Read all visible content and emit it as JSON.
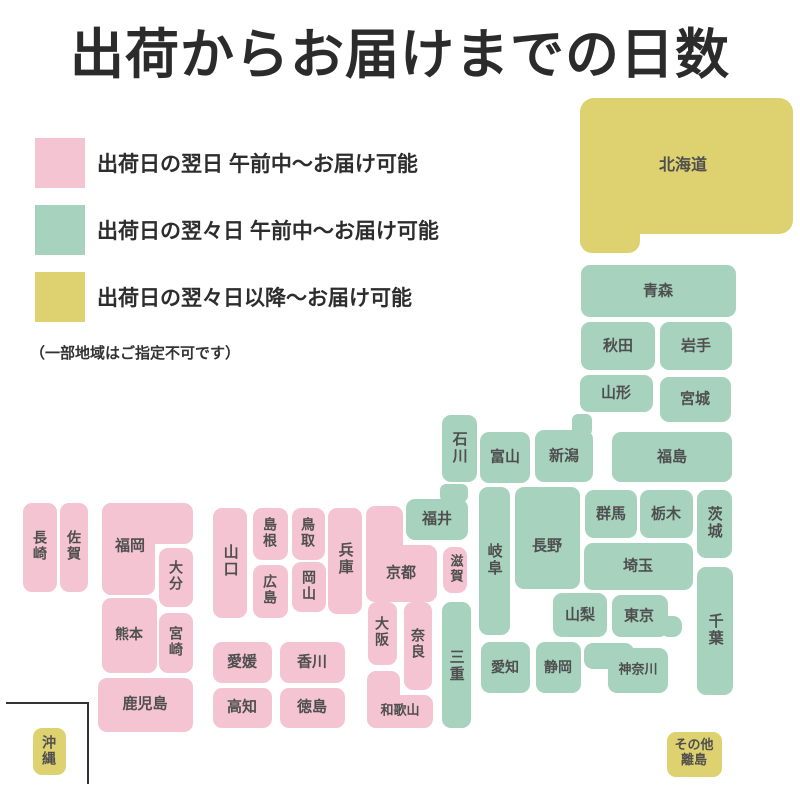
{
  "title": "出荷からお届けまでの日数",
  "legend": {
    "items": [
      {
        "key": "pink",
        "label": "出荷日の翌日 午前中〜お届け可能"
      },
      {
        "key": "green",
        "label": "出荷日の翌々日 午前中〜お届け可能"
      },
      {
        "key": "yellow",
        "label": "出荷日の翌々日以降〜お届け可能"
      }
    ],
    "note": "（一部地域はご指定不可です）"
  },
  "colors": {
    "pink": "#F4C4D3",
    "green": "#A7D3BE",
    "yellow": "#DED16F",
    "label_text": "#4F4F4F",
    "title_text": "#2B2B2B",
    "inset_frame": "#333333"
  },
  "map": {
    "regions": [
      {
        "id": "hokkaido",
        "label": "北海道",
        "color": "yellow",
        "rects": [
          [
            580,
            98,
            213,
            136,
            14
          ],
          [
            580,
            200,
            60,
            53,
            12
          ]
        ],
        "lc": [
          683,
          166
        ],
        "fs": 16
      },
      {
        "id": "aomori",
        "label": "青森",
        "color": "green",
        "rects": [
          [
            581,
            265,
            155,
            52
          ]
        ],
        "lc": [
          658,
          291
        ]
      },
      {
        "id": "akita",
        "label": "秋田",
        "color": "green",
        "rects": [
          [
            581,
            322,
            74,
            48
          ]
        ],
        "lc": [
          618,
          346
        ]
      },
      {
        "id": "iwate",
        "label": "岩手",
        "color": "green",
        "rects": [
          [
            660,
            322,
            72,
            48
          ]
        ],
        "lc": [
          696,
          346
        ]
      },
      {
        "id": "yamagata",
        "label": "山形",
        "color": "green",
        "rects": [
          [
            580,
            375,
            73,
            37
          ]
        ],
        "lc": [
          616,
          393
        ]
      },
      {
        "id": "miyagi",
        "label": "宮城",
        "color": "green",
        "rects": [
          [
            660,
            377,
            71,
            45
          ]
        ],
        "lc": [
          695,
          399
        ]
      },
      {
        "id": "niigata",
        "label": "新潟",
        "color": "green",
        "rects": [
          [
            535,
            430,
            58,
            52
          ],
          [
            572,
            414,
            20,
            22,
            6
          ]
        ],
        "lc": [
          564,
          456
        ]
      },
      {
        "id": "fukushima",
        "label": "福島",
        "color": "green",
        "rects": [
          [
            612,
            432,
            120,
            50
          ]
        ],
        "lc": [
          672,
          457
        ]
      },
      {
        "id": "ishikawa",
        "label": "石川",
        "color": "green",
        "v": true,
        "rects": [
          [
            442,
            415,
            35,
            67
          ]
        ],
        "lc": [
          459,
          448
        ]
      },
      {
        "id": "toyama",
        "label": "富山",
        "color": "green",
        "rects": [
          [
            480,
            432,
            50,
            51
          ]
        ],
        "lc": [
          505,
          457
        ]
      },
      {
        "id": "gunma",
        "label": "群馬",
        "color": "green",
        "rects": [
          [
            585,
            490,
            52,
            48
          ]
        ],
        "lc": [
          611,
          514
        ]
      },
      {
        "id": "tochigi",
        "label": "栃木",
        "color": "green",
        "rects": [
          [
            640,
            490,
            53,
            48
          ]
        ],
        "lc": [
          666,
          514
        ]
      },
      {
        "id": "ibaraki",
        "label": "茨城",
        "color": "green",
        "v": true,
        "rects": [
          [
            697,
            490,
            35,
            68
          ]
        ],
        "lc": [
          714,
          523
        ]
      },
      {
        "id": "fukui",
        "label": "福井",
        "color": "green",
        "rects": [
          [
            406,
            499,
            62,
            41
          ],
          [
            440,
            484,
            28,
            18,
            6
          ]
        ],
        "lc": [
          437,
          519
        ]
      },
      {
        "id": "gifu",
        "label": "岐阜",
        "color": "green",
        "v": true,
        "rects": [
          [
            479,
            487,
            31,
            148
          ]
        ],
        "lc": [
          494,
          560
        ]
      },
      {
        "id": "nagano",
        "label": "長野",
        "color": "green",
        "rects": [
          [
            515,
            487,
            65,
            102
          ]
        ],
        "lc": [
          547,
          546
        ]
      },
      {
        "id": "saitama",
        "label": "埼玉",
        "color": "green",
        "rects": [
          [
            584,
            543,
            109,
            47
          ]
        ],
        "lc": [
          638,
          566
        ]
      },
      {
        "id": "tokyo",
        "label": "東京",
        "color": "green",
        "rects": [
          [
            612,
            595,
            56,
            42
          ],
          [
            660,
            616,
            22,
            21
          ]
        ],
        "lc": [
          639,
          616
        ]
      },
      {
        "id": "chiba",
        "label": "千葉",
        "color": "green",
        "v": true,
        "rects": [
          [
            697,
            567,
            36,
            128
          ]
        ],
        "lc": [
          715,
          630
        ]
      },
      {
        "id": "yamanashi",
        "label": "山梨",
        "color": "green",
        "rects": [
          [
            553,
            593,
            54,
            44
          ]
        ],
        "lc": [
          580,
          615
        ]
      },
      {
        "id": "kanagawa",
        "label": "神奈川",
        "color": "green",
        "rects": [
          [
            608,
            648,
            60,
            45
          ],
          [
            584,
            643,
            50,
            26
          ]
        ],
        "lc": [
          638,
          670
        ],
        "fs": 13
      },
      {
        "id": "shizuoka",
        "label": "静岡",
        "color": "green",
        "rects": [
          [
            536,
            642,
            45,
            51
          ]
        ],
        "lc": [
          558,
          667
        ],
        "fs": 14
      },
      {
        "id": "aichi",
        "label": "愛知",
        "color": "green",
        "rects": [
          [
            481,
            642,
            49,
            51
          ]
        ],
        "lc": [
          505,
          667
        ],
        "fs": 14
      },
      {
        "id": "mie",
        "label": "三重",
        "color": "green",
        "v": true,
        "rects": [
          [
            442,
            602,
            29,
            126
          ]
        ],
        "lc": [
          456,
          666
        ]
      },
      {
        "id": "shiga",
        "label": "滋賀",
        "color": "pink",
        "v": true,
        "rects": [
          [
            443,
            547,
            24,
            46
          ]
        ],
        "lc": [
          455,
          569
        ],
        "fs": 13
      },
      {
        "id": "kyoto",
        "label": "京都",
        "color": "pink",
        "rects": [
          [
            366,
            506,
            37,
            96
          ],
          [
            366,
            545,
            71,
            57
          ]
        ],
        "lc": [
          401,
          573
        ]
      },
      {
        "id": "hyogo",
        "label": "兵庫",
        "color": "pink",
        "v": true,
        "rects": [
          [
            328,
            508,
            34,
            106
          ]
        ],
        "lc": [
          345,
          559
        ]
      },
      {
        "id": "osaka",
        "label": "大阪",
        "color": "pink",
        "v": true,
        "rects": [
          [
            368,
            602,
            29,
            63
          ]
        ],
        "lc": [
          382,
          632
        ],
        "fs": 14
      },
      {
        "id": "nara",
        "label": "奈良",
        "color": "pink",
        "v": true,
        "rects": [
          [
            404,
            602,
            28,
            88
          ]
        ],
        "lc": [
          418,
          644
        ],
        "fs": 14
      },
      {
        "id": "wakayama",
        "label": "和歌山",
        "color": "pink",
        "rects": [
          [
            367,
            671,
            33,
            57
          ],
          [
            367,
            695,
            66,
            33
          ]
        ],
        "lc": [
          400,
          711
        ],
        "fs": 13
      },
      {
        "id": "tottori",
        "label": "鳥取",
        "color": "pink",
        "v": true,
        "rects": [
          [
            292,
            508,
            33,
            52
          ]
        ],
        "lc": [
          308,
          533
        ],
        "fs": 14
      },
      {
        "id": "shimane",
        "label": "島根",
        "color": "pink",
        "v": true,
        "rects": [
          [
            253,
            508,
            35,
            52
          ]
        ],
        "lc": [
          270,
          533
        ],
        "fs": 14
      },
      {
        "id": "yamaguchi",
        "label": "山口",
        "color": "pink",
        "v": true,
        "rects": [
          [
            213,
            508,
            34,
            110
          ]
        ],
        "lc": [
          230,
          561
        ]
      },
      {
        "id": "hiroshima",
        "label": "広島",
        "color": "pink",
        "v": true,
        "rects": [
          [
            253,
            565,
            35,
            53
          ]
        ],
        "lc": [
          270,
          590
        ],
        "fs": 14
      },
      {
        "id": "okayama",
        "label": "岡山",
        "color": "pink",
        "v": true,
        "rects": [
          [
            292,
            562,
            34,
            50
          ]
        ],
        "lc": [
          309,
          586
        ],
        "fs": 14
      },
      {
        "id": "ehime",
        "label": "愛媛",
        "color": "pink",
        "rects": [
          [
            213,
            642,
            59,
            41
          ]
        ],
        "lc": [
          242,
          662
        ]
      },
      {
        "id": "kagawa",
        "label": "香川",
        "color": "pink",
        "rects": [
          [
            280,
            642,
            65,
            41
          ]
        ],
        "lc": [
          312,
          662
        ]
      },
      {
        "id": "kochi",
        "label": "高知",
        "color": "pink",
        "rects": [
          [
            213,
            688,
            59,
            40
          ]
        ],
        "lc": [
          242,
          707
        ]
      },
      {
        "id": "tokushima",
        "label": "徳島",
        "color": "pink",
        "rects": [
          [
            280,
            688,
            65,
            40
          ]
        ],
        "lc": [
          312,
          707
        ]
      },
      {
        "id": "fukuoka",
        "label": "福岡",
        "color": "pink",
        "rects": [
          [
            102,
            503,
            91,
            41
          ],
          [
            102,
            503,
            53,
            92
          ]
        ],
        "lc": [
          130,
          546
        ]
      },
      {
        "id": "oita",
        "label": "大分",
        "color": "pink",
        "v": true,
        "rects": [
          [
            159,
            548,
            34,
            59
          ]
        ],
        "lc": [
          176,
          576
        ],
        "fs": 14
      },
      {
        "id": "saga",
        "label": "佐賀",
        "color": "pink",
        "v": true,
        "rects": [
          [
            60,
            503,
            28,
            89
          ]
        ],
        "lc": [
          74,
          546
        ],
        "fs": 14
      },
      {
        "id": "nagasaki",
        "label": "長崎",
        "color": "pink",
        "v": true,
        "rects": [
          [
            23,
            503,
            34,
            89
          ]
        ],
        "lc": [
          40,
          546
        ],
        "fs": 14
      },
      {
        "id": "kumamoto",
        "label": "熊本",
        "color": "pink",
        "rects": [
          [
            102,
            598,
            55,
            75
          ]
        ],
        "lc": [
          129,
          634
        ],
        "fs": 14
      },
      {
        "id": "miyazaki",
        "label": "宮崎",
        "color": "pink",
        "v": true,
        "rects": [
          [
            159,
            613,
            34,
            60
          ]
        ],
        "lc": [
          176,
          642
        ],
        "fs": 14
      },
      {
        "id": "kagoshima",
        "label": "鹿児島",
        "color": "pink",
        "rects": [
          [
            98,
            678,
            95,
            54
          ]
        ],
        "lc": [
          145,
          704
        ]
      },
      {
        "id": "okinawa",
        "label": "沖縄",
        "color": "yellow",
        "v": true,
        "rects": [
          [
            33,
            728,
            33,
            47
          ]
        ],
        "lc": [
          49,
          751
        ],
        "fs": 14
      },
      {
        "id": "other-islands",
        "label": "その他\n離島",
        "color": "yellow",
        "rects": [
          [
            667,
            732,
            55,
            45
          ]
        ],
        "lc": [
          694,
          753
        ],
        "fs": 13
      }
    ]
  }
}
